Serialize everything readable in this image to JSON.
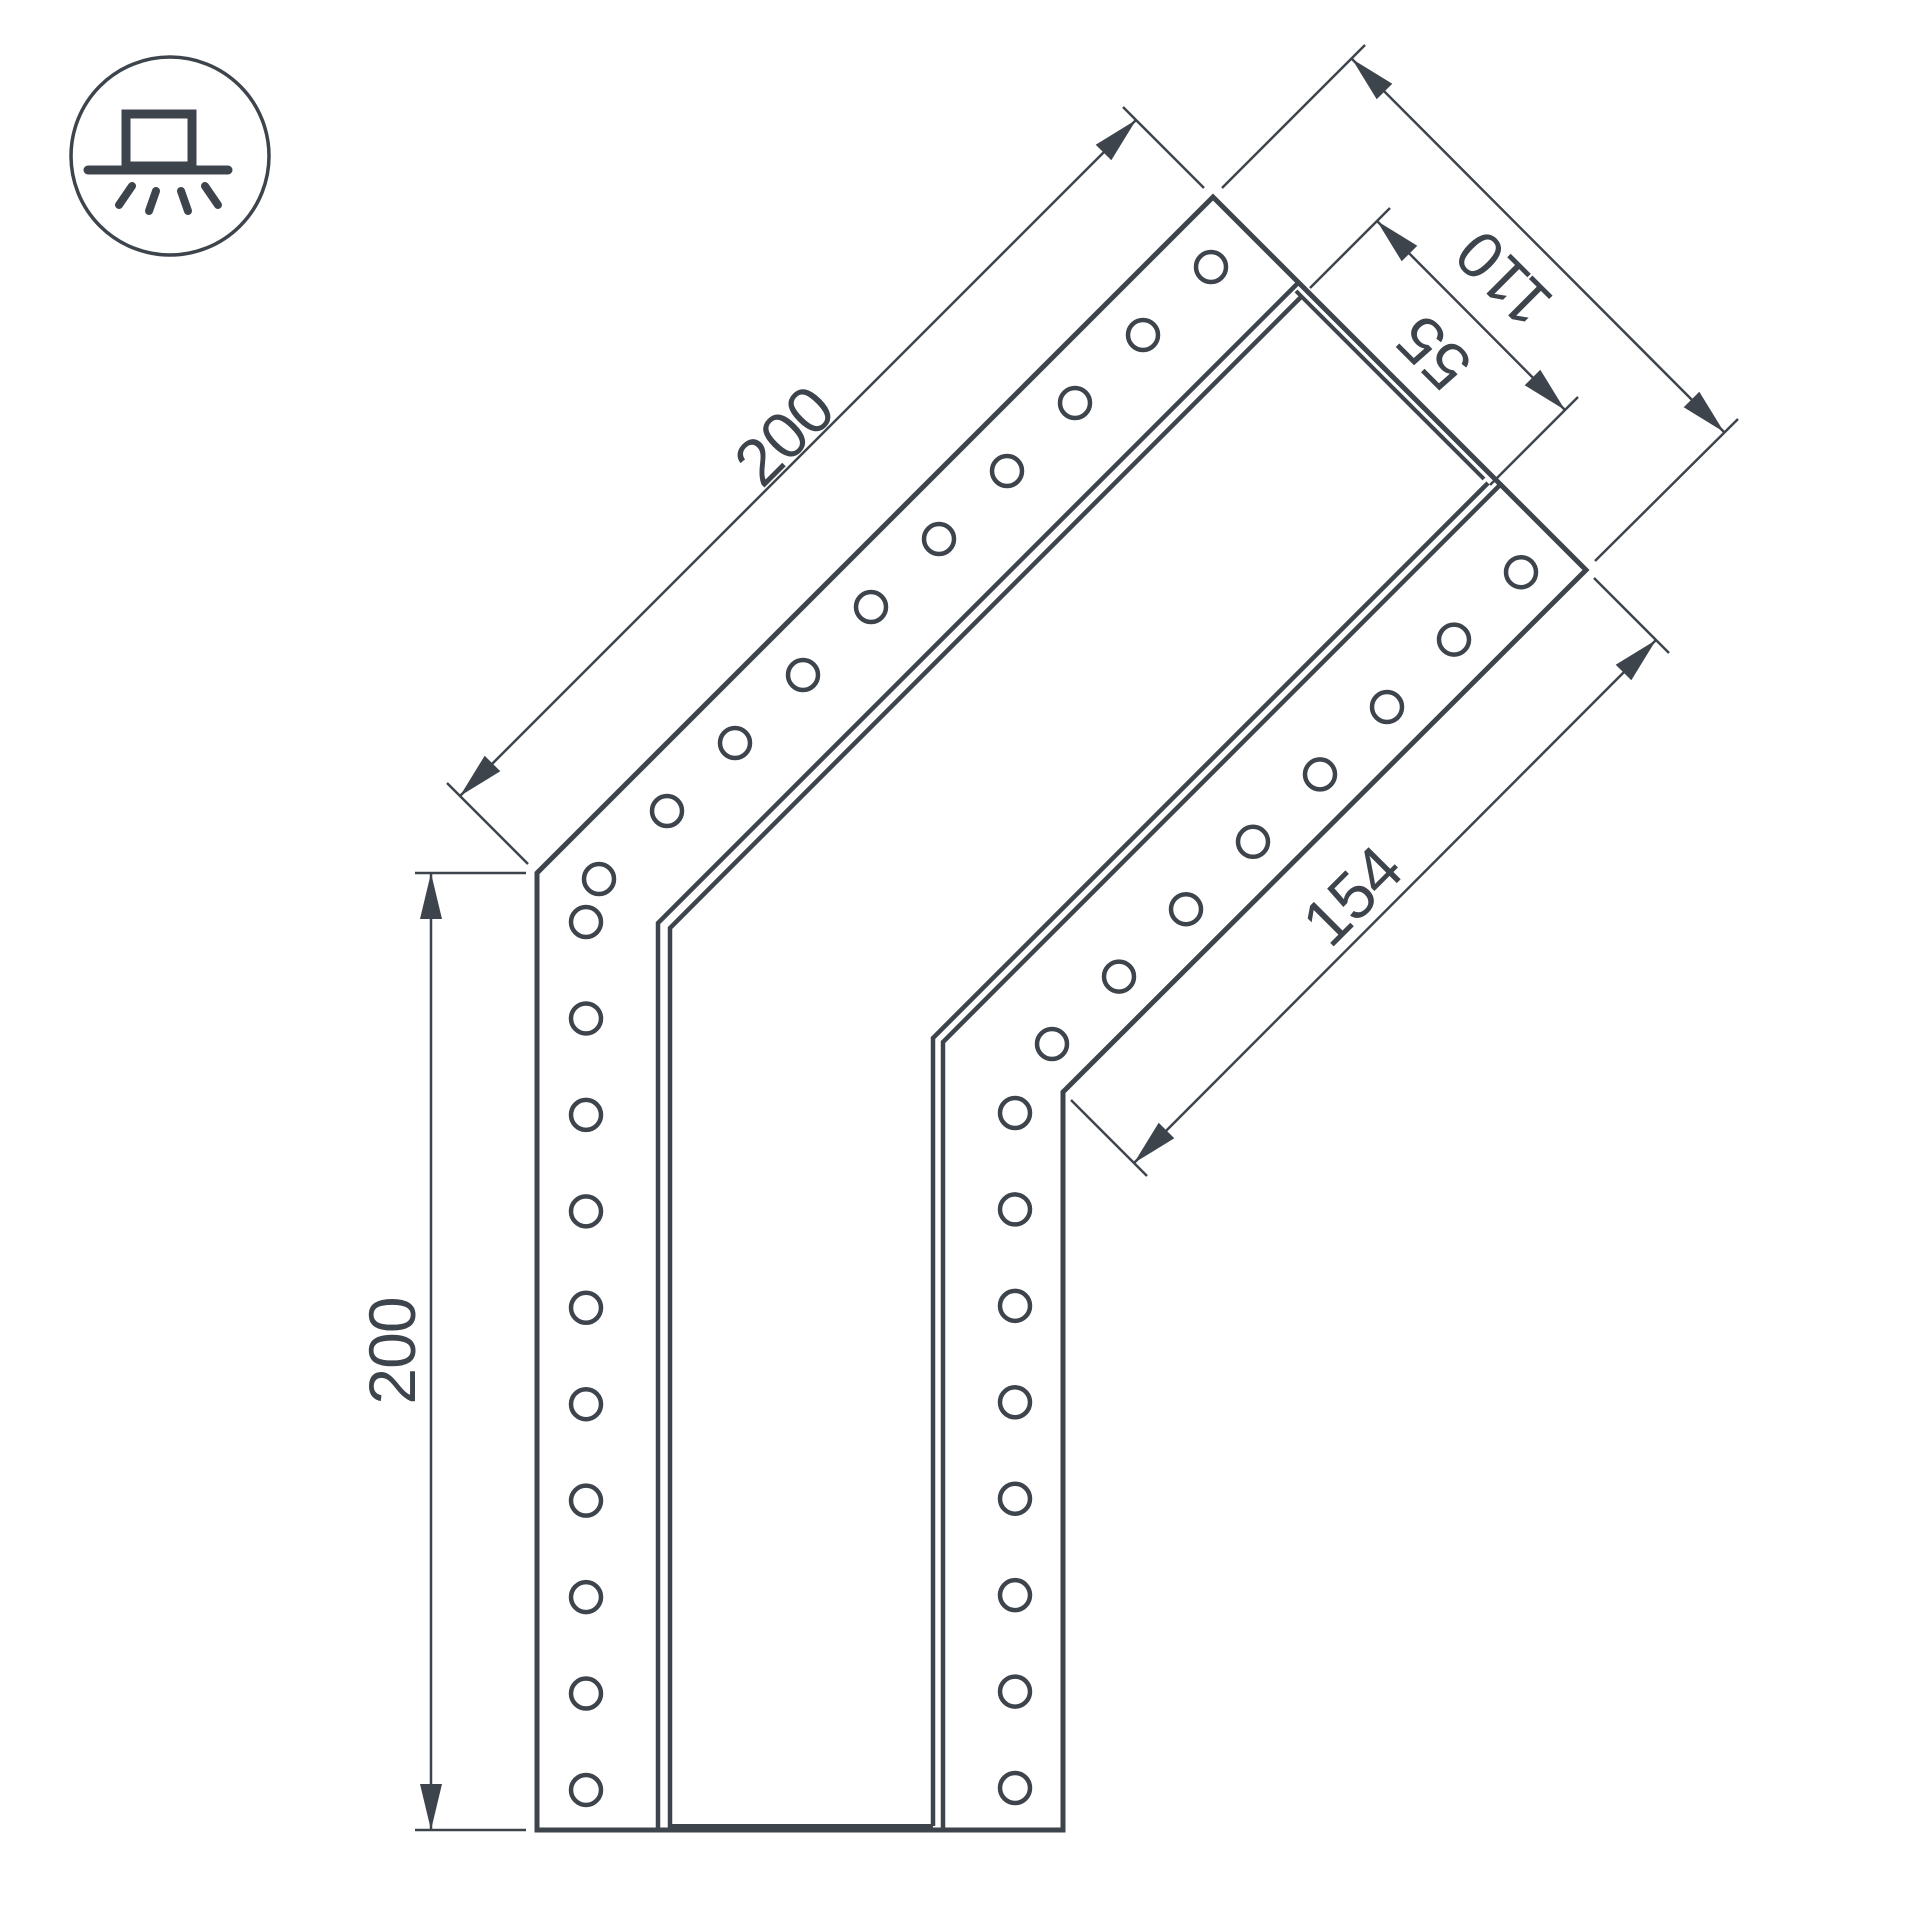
{
  "colors": {
    "line": "#3d444c",
    "background": "#ffffff"
  },
  "icon": {
    "symbol": "surface-mount-light"
  },
  "dimensions": {
    "outer_diagonal_length": "200",
    "vertical_length": "200",
    "inner_diagonal_length": "154",
    "profile_width": "110",
    "channel_width": "55"
  }
}
